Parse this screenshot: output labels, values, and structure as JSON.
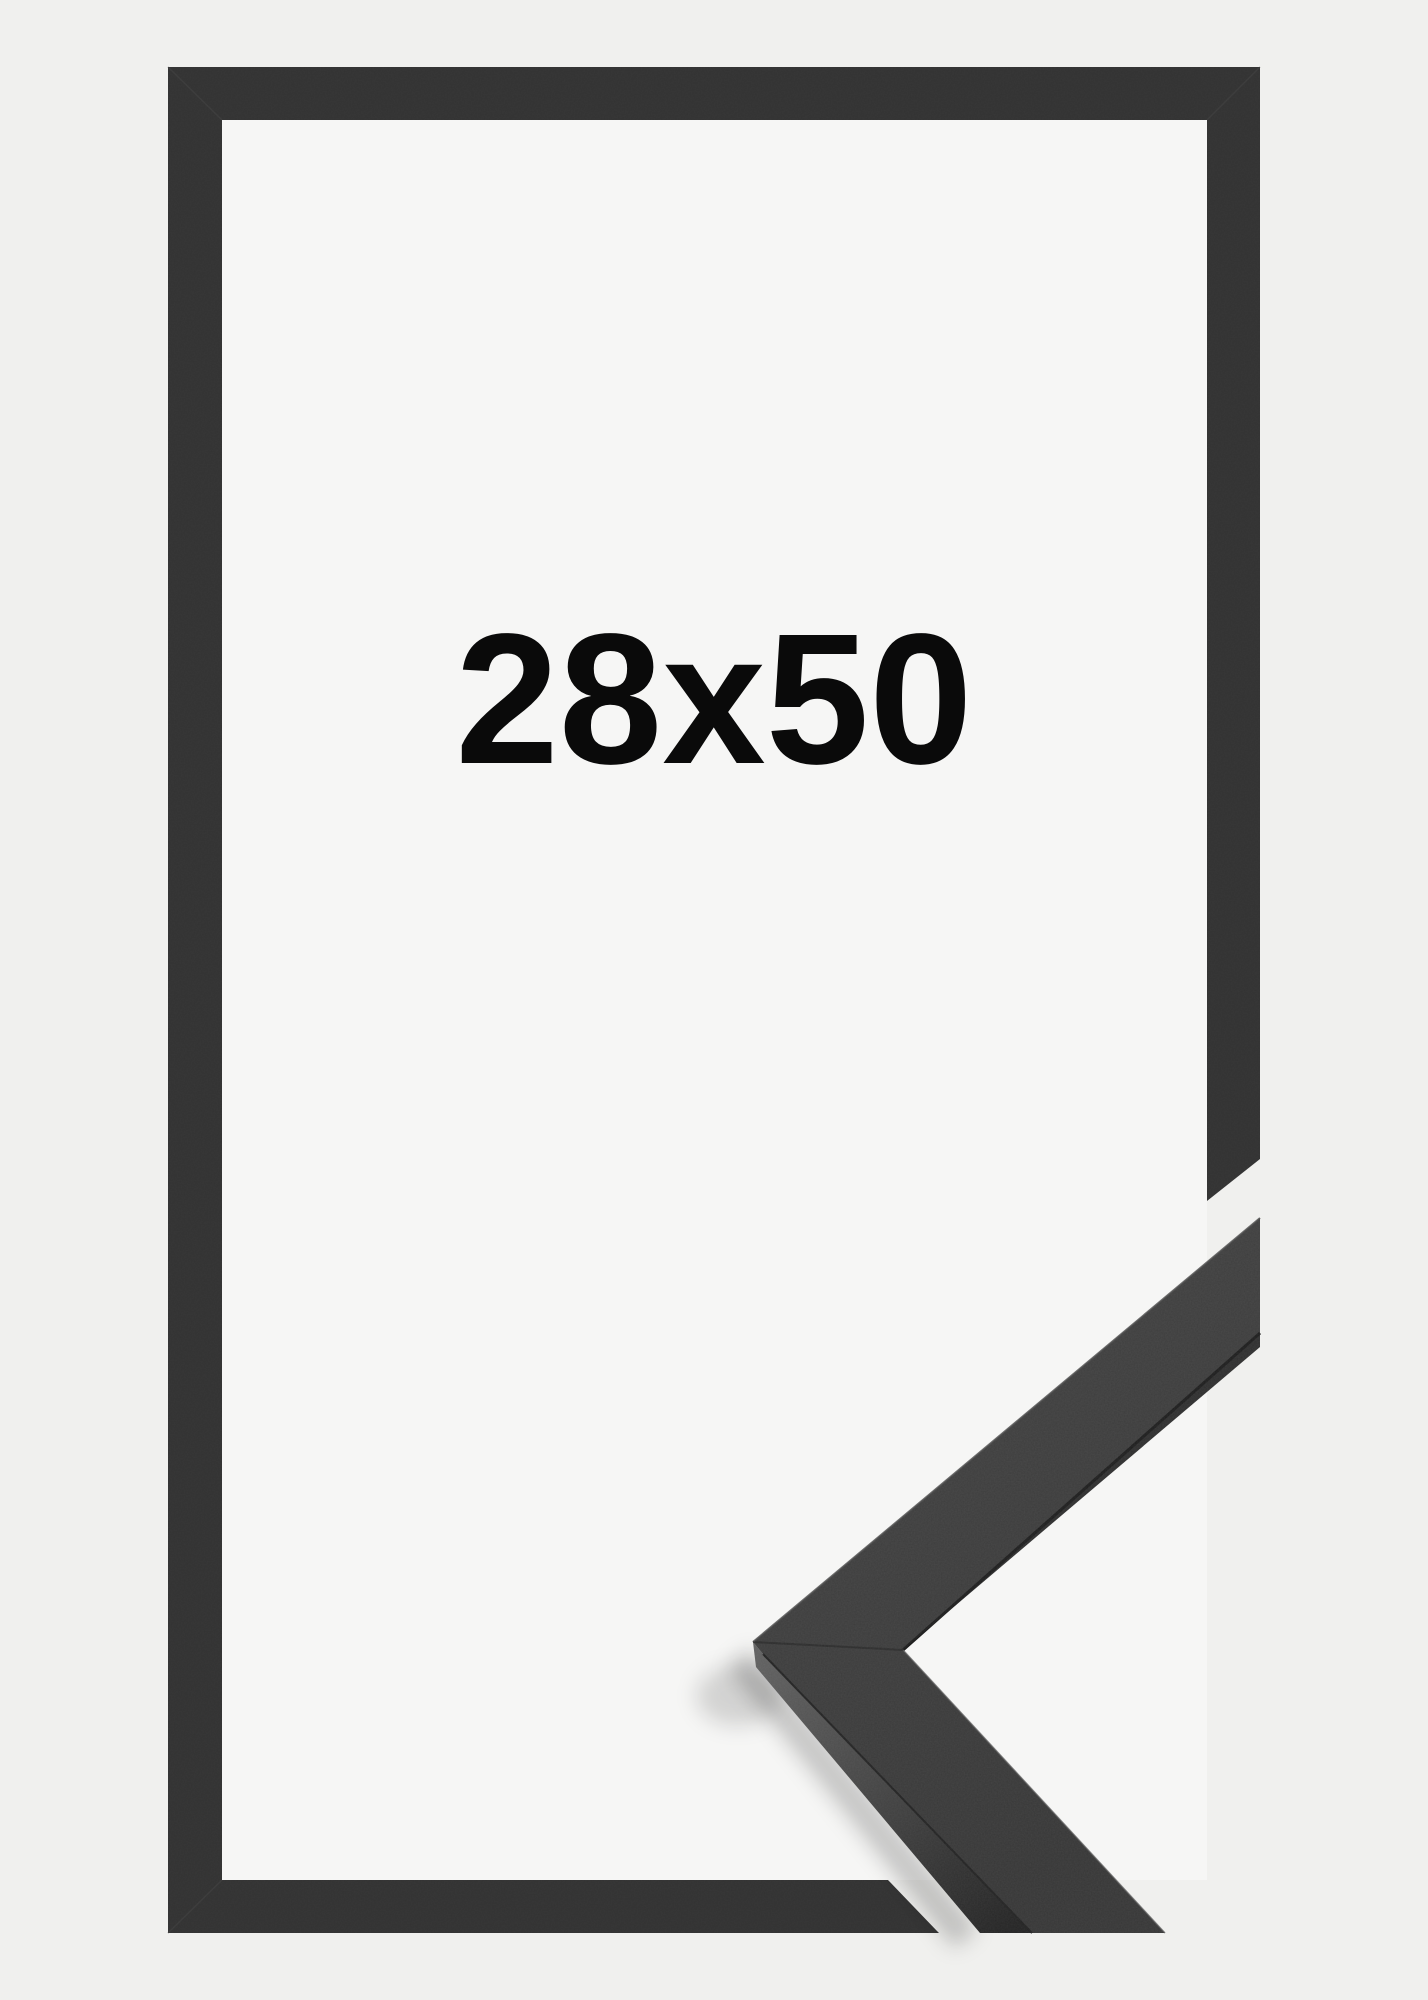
{
  "product_image": {
    "size_label": "28x50",
    "colors": {
      "background": "#f0f0ee",
      "frame": "#323232",
      "interior": "#f6f6f5",
      "moulding_top": "#3c3c3c",
      "moulding_top_light": "#414141",
      "moulding_side_dark": "#2e2e2e",
      "moulding_side_light": "#5e5e5e",
      "crease": "#1d1d1d",
      "label_text": "#0a0a0a"
    }
  }
}
